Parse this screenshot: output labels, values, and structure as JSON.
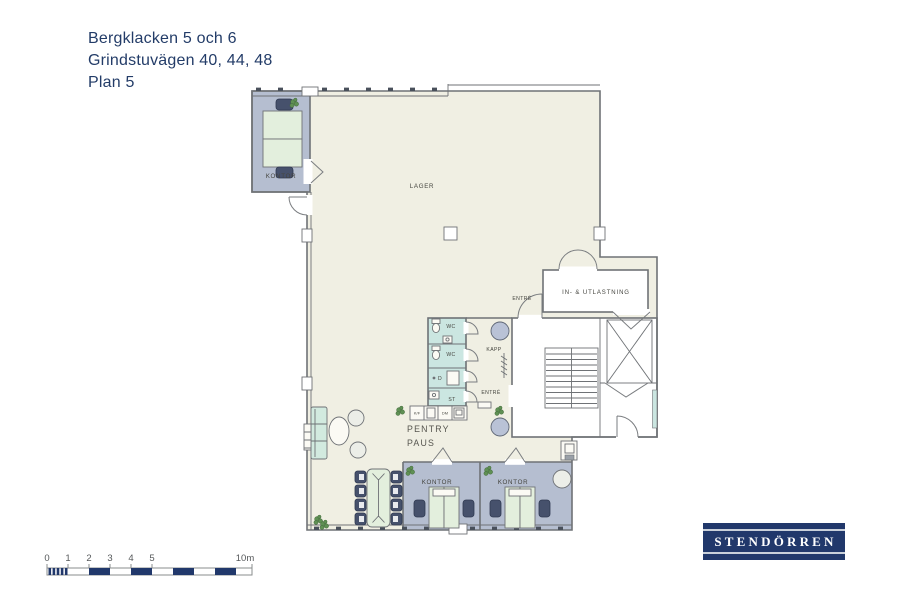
{
  "title": {
    "line1": "Bergklacken 5 och 6",
    "line2": "Grindstuvägen 40, 44, 48",
    "line3": "Plan 5"
  },
  "plan_labels": {
    "kontor_nw": "KONTOR",
    "lager": "LAGER",
    "entre_upper": "ENTRÉ",
    "in_utlastning": "IN- & UTLASTNING",
    "wc_1": "WC",
    "wc_2": "WC",
    "dusch": "D",
    "stad": "ST",
    "kapp": "KAPP",
    "entre_lower": "ENTRÉ",
    "pentry": "PENTRY",
    "paus": "PAUS",
    "kontor_sw": "KONTOR",
    "kontor_se": "KONTOR",
    "fridge_freezer": "K/F",
    "dishwasher": "DM"
  },
  "scale_bar": {
    "ticks": [
      "0",
      "1",
      "2",
      "3",
      "4",
      "5"
    ],
    "end_label": "10m"
  },
  "logo": {
    "text": "STENDÖRREN"
  },
  "colors": {
    "title_text": "#233c68",
    "lager_fill": "#f0efe3",
    "office_fill": "#b5bed0",
    "wet_room_fill": "#cbe6e1",
    "furniture_green": "#e3efdd",
    "plant_green": "#5f9054",
    "wall_gray": "#6f7276",
    "navy": "#21386b"
  }
}
